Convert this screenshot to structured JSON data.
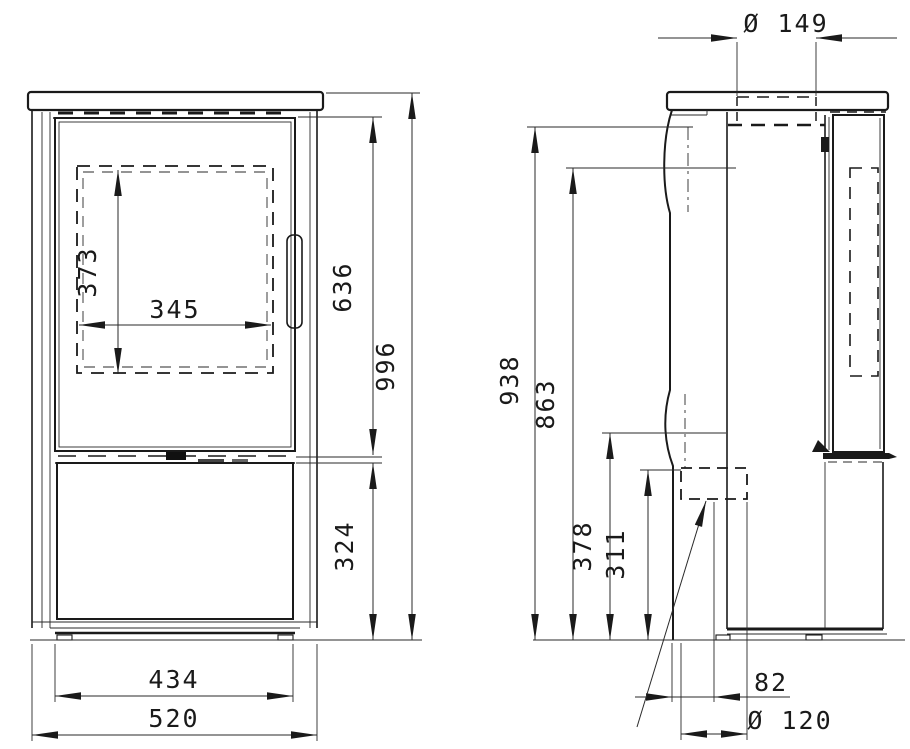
{
  "drawing": {
    "front_view": {
      "dimensions": [
        {
          "id": "glass-height",
          "text": "373"
        },
        {
          "id": "glass-width",
          "text": "345"
        },
        {
          "id": "upper-section-height",
          "text": "636"
        },
        {
          "id": "overall-height",
          "text": "996"
        },
        {
          "id": "base-section-height",
          "text": "324"
        },
        {
          "id": "inner-width",
          "text": "434"
        },
        {
          "id": "overall-width",
          "text": "520"
        }
      ]
    },
    "side_view": {
      "dimensions": [
        {
          "id": "flue-collar-diameter",
          "text": "Ø 149"
        },
        {
          "id": "height-938",
          "text": "938"
        },
        {
          "id": "height-863",
          "text": "863"
        },
        {
          "id": "height-378",
          "text": "378"
        },
        {
          "id": "height-311",
          "text": "311"
        },
        {
          "id": "rear-outlet-offset",
          "text": "82"
        },
        {
          "id": "rear-outlet-diameter",
          "text": "Ø 120"
        }
      ]
    }
  }
}
